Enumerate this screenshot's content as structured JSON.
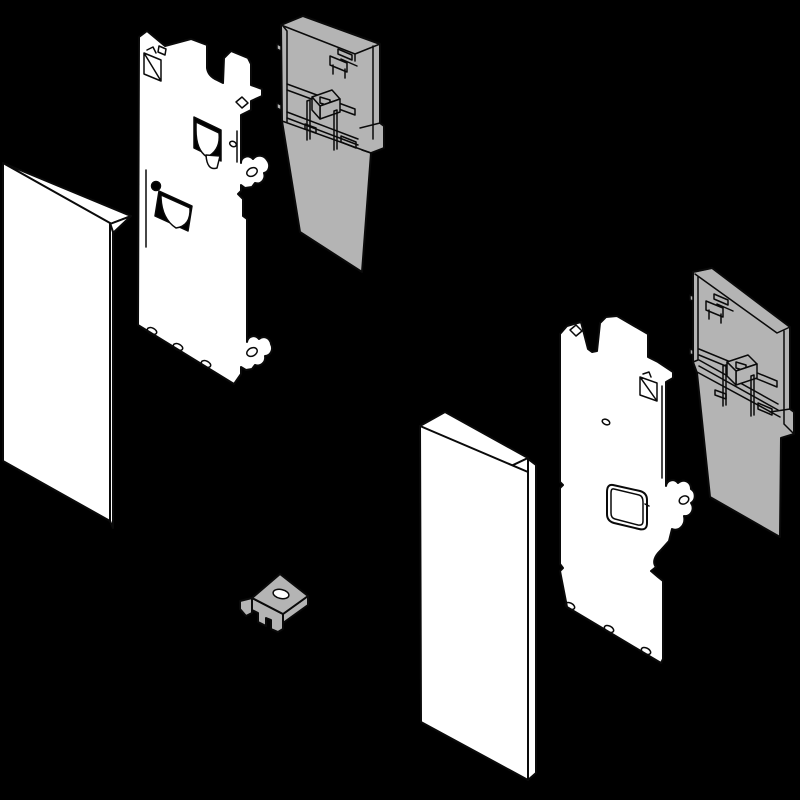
{
  "scene": {
    "background": "#000000",
    "stroke": "#0a0a0a",
    "white": "#ffffff",
    "gray": "#b4b4b4",
    "description_name": "exploded-assembly-diagram",
    "text_content": []
  },
  "parts": [
    {
      "name": "front-panel-left",
      "fill": "#ffffff"
    },
    {
      "name": "bracket-plate-left",
      "fill": "#ffffff"
    },
    {
      "name": "housing-left",
      "fill": "#b4b4b4"
    },
    {
      "name": "clip-nut-center",
      "fill": "#b4b4b4"
    },
    {
      "name": "front-panel-right",
      "fill": "#ffffff"
    },
    {
      "name": "bracket-plate-right",
      "fill": "#ffffff"
    },
    {
      "name": "housing-right",
      "fill": "#b4b4b4"
    }
  ]
}
